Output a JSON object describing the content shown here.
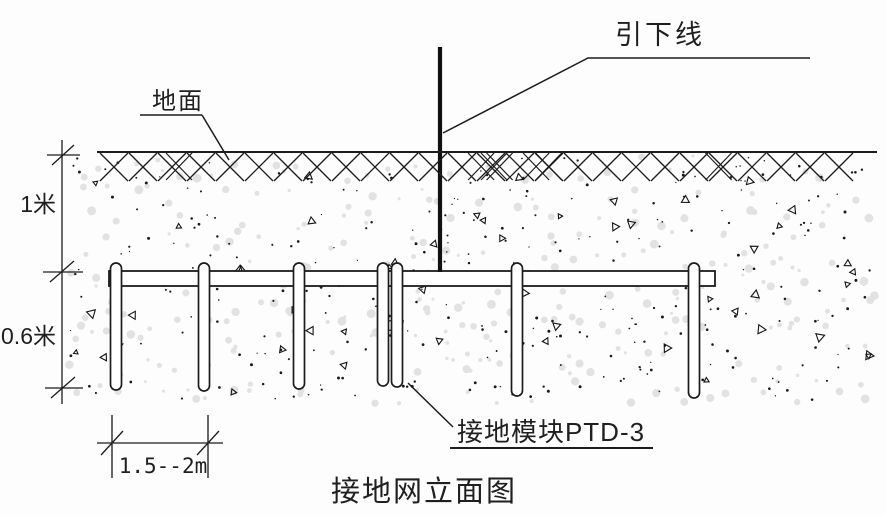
{
  "title": "接地网立面图",
  "labels": {
    "down_lead": "引下线",
    "ground_surface": "地面",
    "ground_module": "接地模块PTD-3"
  },
  "dimensions": {
    "burial_depth": "1米",
    "module_depth": "0.6米",
    "module_spacing": "1.5--2m"
  },
  "diagram": {
    "colors": {
      "line": "#1c1c1c",
      "background": "#fdfdfd",
      "speckle_light": "#e2e2e2",
      "speckle_dark": "#1a1a1a"
    },
    "ground_rods": [
      {
        "x": 116,
        "bottom": 390
      },
      {
        "x": 204,
        "bottom": 391
      },
      {
        "x": 299,
        "bottom": 389
      },
      {
        "x": 383,
        "bottom": 386
      },
      {
        "x": 397,
        "bottom": 387
      },
      {
        "x": 517,
        "bottom": 396
      },
      {
        "x": 694,
        "bottom": 398
      }
    ]
  }
}
